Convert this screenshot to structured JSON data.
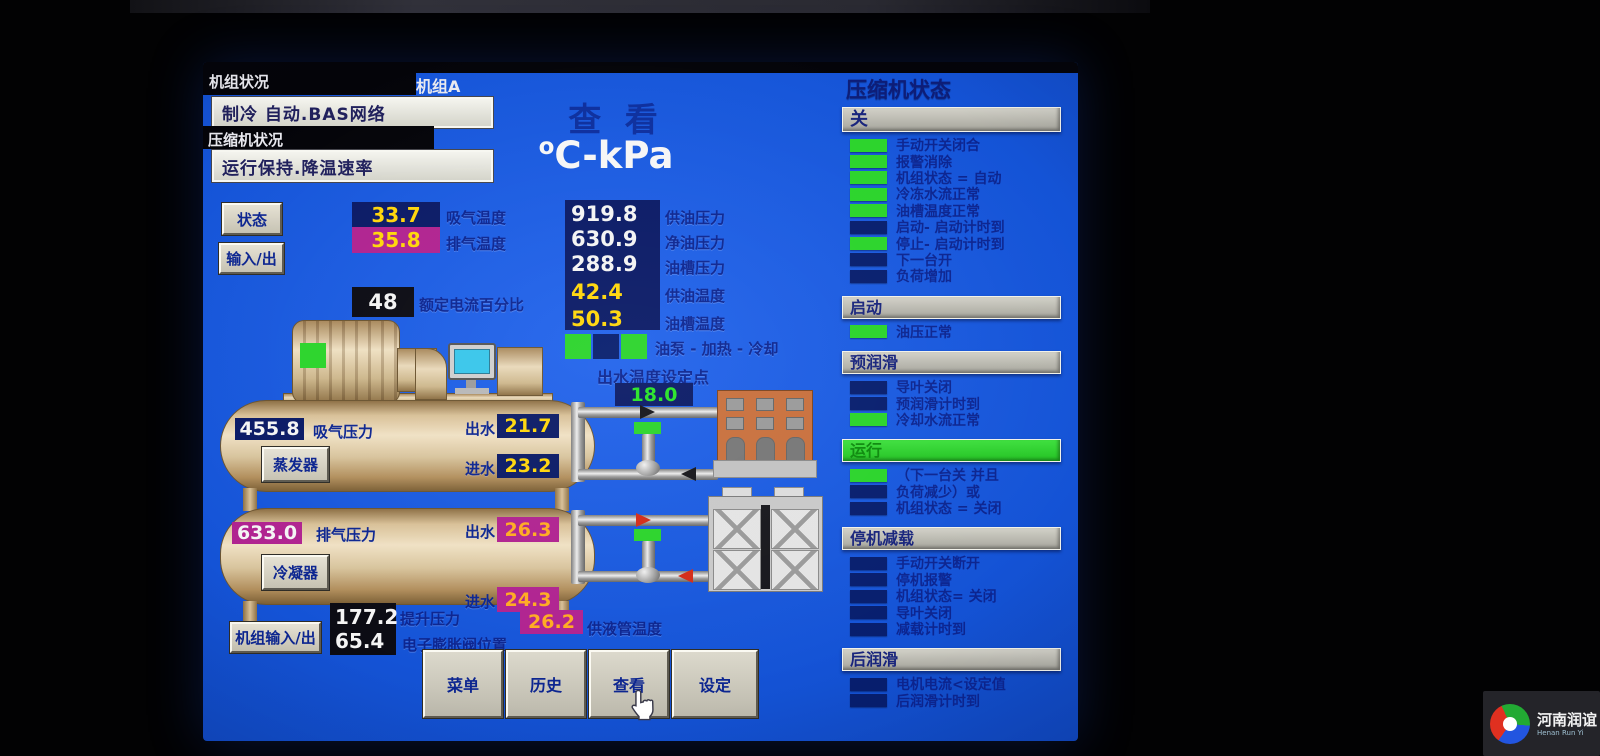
{
  "header": {
    "unit_status_label": "机组状况",
    "unit_status_value": "制冷  自动.BAS网络",
    "compressor_status_label": "压缩机状况",
    "compressor_status_value": "运行保持.降温速率",
    "unit_name": "机组A",
    "view_title": "查 看",
    "degree_symbol": "o",
    "units_title": "C-kPa"
  },
  "nav": {
    "status_button": "状态",
    "io_button": "输入/出",
    "unit_io_button": "机组输入/出"
  },
  "readings": {
    "suction_temp": {
      "value": "33.7",
      "label": "吸气温度"
    },
    "discharge_temp": {
      "value": "35.8",
      "label": "排气温度"
    },
    "fla_percent": {
      "value": "48",
      "label": "额定电流百分比"
    },
    "oil_supply_pressure": {
      "value": "919.8",
      "label": "供油压力"
    },
    "net_oil_pressure": {
      "value": "630.9",
      "label": "净油压力"
    },
    "sump_pressure": {
      "value": "288.9",
      "label": "油槽压力"
    },
    "oil_supply_temp": {
      "value": "42.4",
      "label": "供油温度"
    },
    "sump_temp": {
      "value": "50.3",
      "label": "油槽温度"
    },
    "oil_pump_label": "油泵 - 加热 - 冷却",
    "oil_pump_leds": [
      "green",
      "dark",
      "green"
    ],
    "leaving_water_setpoint_label": "出水温度设定点",
    "leaving_water_setpoint": "18.0",
    "suction_pressure": {
      "value": "455.8",
      "label": "吸气压力"
    },
    "evap_leaving": {
      "label": "出水",
      "value": "21.7"
    },
    "evap_entering": {
      "label": "进水",
      "value": "23.2"
    },
    "discharge_pressure": {
      "value": "633.0",
      "label": "排气压力"
    },
    "cond_leaving": {
      "label": "出水",
      "value": "26.3"
    },
    "cond_entering": {
      "label": "进水",
      "value": "24.3"
    },
    "lift_pressure": {
      "value": "177.2",
      "label": "提升压力"
    },
    "eev_position": {
      "value": "65.4",
      "label": "电子膨胀阀位置"
    },
    "liquid_line_temp": {
      "value": "26.2",
      "label": "供液管温度"
    }
  },
  "equipment": {
    "evaporator_button": "蒸发器",
    "condenser_button": "冷凝器"
  },
  "bottom_buttons": [
    "菜单",
    "历史",
    "查看",
    "设定"
  ],
  "compressor_panel": {
    "title": "压缩机状态",
    "sections": [
      {
        "header": "关",
        "style": "grey",
        "items": [
          {
            "text": "手动开关闭合",
            "led": "green"
          },
          {
            "text": "报警消除",
            "led": "green"
          },
          {
            "text": "机组状态 =  自动",
            "led": "green"
          },
          {
            "text": "冷冻水流正常",
            "led": "green"
          },
          {
            "text": "油槽温度正常",
            "led": "green"
          },
          {
            "text": "启动- 启动计时到",
            "led": "dark"
          },
          {
            "text": "停止- 启动计时到",
            "led": "green"
          },
          {
            "text": "下一台开",
            "led": "dark"
          },
          {
            "text": "负荷增加",
            "led": "dark"
          }
        ]
      },
      {
        "header": "启动",
        "style": "grey",
        "items": [
          {
            "text": "油压正常",
            "led": "green"
          }
        ]
      },
      {
        "header": "预润滑",
        "style": "grey",
        "items": [
          {
            "text": "导叶关闭",
            "led": "dark"
          },
          {
            "text": "预润滑计时到",
            "led": "dark"
          },
          {
            "text": "冷却水流正常",
            "led": "green"
          }
        ]
      },
      {
        "header": "运行",
        "style": "green",
        "items": [
          {
            "text": "（下一台关 并且",
            "led": "green"
          },
          {
            "text": "负荷减少）或",
            "led": "dark"
          },
          {
            "text": "机组状态 =  关闭",
            "led": "dark"
          }
        ]
      },
      {
        "header": "停机减载",
        "style": "grey",
        "items": [
          {
            "text": "手动开关断开",
            "led": "dark"
          },
          {
            "text": "停机报警",
            "led": "dark"
          },
          {
            "text": "机组状态= 关闭",
            "led": "dark"
          },
          {
            "text": "导叶关闭",
            "led": "dark"
          },
          {
            "text": "减载计时到",
            "led": "dark"
          }
        ]
      },
      {
        "header": "后润滑",
        "style": "grey",
        "items": [
          {
            "text": "电机电流<设定值",
            "led": "dark"
          },
          {
            "text": "后润滑计时到",
            "led": "dark"
          }
        ]
      }
    ]
  },
  "watermark": {
    "cn": "河南润谊",
    "en": "Henan Run Yi"
  },
  "colors": {
    "screen_blue": "#1453d6",
    "navy_box": "#0a1a66",
    "magenta_box": "#b02390",
    "value_yellow": "#ffd60a",
    "setpoint_green": "#27e427",
    "led_green": "#2bd42b",
    "led_dark": "#071e6e",
    "label_navy": "#0c2590",
    "tank_tan": "#d8c097"
  }
}
